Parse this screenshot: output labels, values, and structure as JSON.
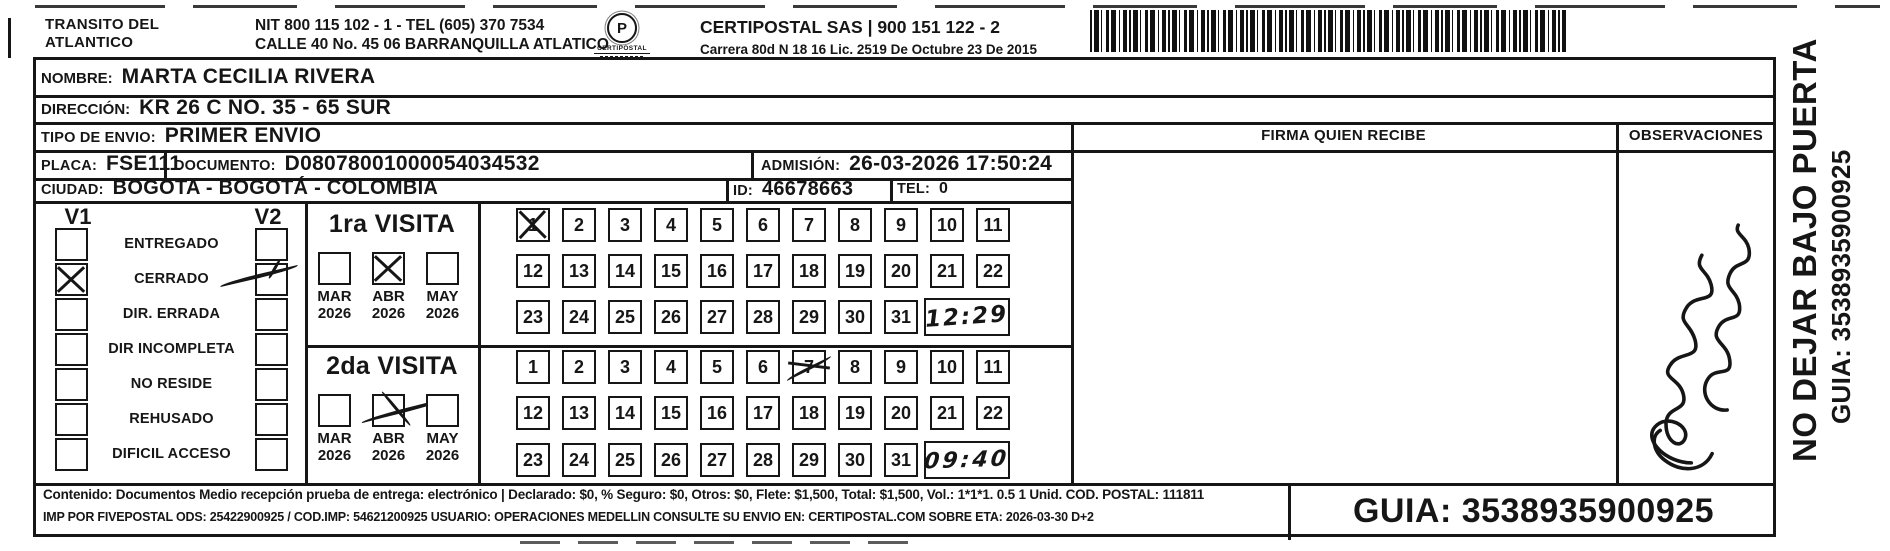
{
  "ink_color": "#161616",
  "paper_color": "#ffffff",
  "header": {
    "sender_line1": "TRANSITO DEL",
    "sender_line2": "ATLANTICO",
    "nit_line": "NIT 800 115 102 - 1 - TEL (605) 370 7534",
    "address_line": "CALLE 40 No. 45 06 BARRANQUILLA ATLATICO",
    "logo_glyph": "P",
    "logo_text": "CERTIPOSTAL",
    "company_line": "CERTIPOSTAL SAS | 900 151 122 - 2",
    "license_line": "Carrera 80d N 18 16  Lic. 2519 De Octubre 23 De 2015"
  },
  "fields": {
    "nombre_label": "NOMBRE:",
    "nombre": "MARTA CECILIA RIVERA",
    "direccion_label": "DIRECCIÓN:",
    "direccion": "KR 26 C NO. 35 - 65 SUR",
    "tipo_label": "TIPO DE ENVIO:",
    "tipo": "PRIMER ENVIO",
    "placa_label": "PLACA:",
    "placa": "FSE111",
    "documento_label": "DOCUMENTO:",
    "documento": "D08078001000054034532",
    "admision_label": "ADMISIÓN:",
    "admision": "26-03-2026 17:50:24",
    "ciudad_label": "CIUDAD:",
    "ciudad": "BOGOTA - BOGOTÁ - COLOMBIA",
    "id_label": "ID:",
    "id": "46678663",
    "tel_label": "TEL:",
    "tel": "0"
  },
  "columns": {
    "firma": "FIRMA QUIEN RECIBE",
    "observaciones": "OBSERVACIONES"
  },
  "status_panel": {
    "v1_header": "V1",
    "v2_header": "V2",
    "rows": [
      {
        "label": "ENTREGADO",
        "v1_checked": false,
        "v2_checked": false
      },
      {
        "label": "CERRADO",
        "v1_checked": true,
        "v1_mark": "printed-x",
        "v2_checked": true,
        "v2_mark": "handwritten"
      },
      {
        "label": "DIR. ERRADA",
        "v1_checked": false,
        "v2_checked": false
      },
      {
        "label": "DIR INCOMPLETA",
        "v1_checked": false,
        "v2_checked": false
      },
      {
        "label": "NO RESIDE",
        "v1_checked": false,
        "v2_checked": false
      },
      {
        "label": "REHUSADO",
        "v1_checked": false,
        "v2_checked": false
      },
      {
        "label": "DIFICIL ACCESO",
        "v1_checked": false,
        "v2_checked": false
      }
    ]
  },
  "visits": [
    {
      "title": "1ra VISITA",
      "months": [
        {
          "month": "MAR",
          "year": "2026",
          "checked": false
        },
        {
          "month": "ABR",
          "year": "2026",
          "checked": true,
          "mark": "printed-x"
        },
        {
          "month": "MAY",
          "year": "2026",
          "checked": false
        }
      ],
      "days": [
        1,
        2,
        3,
        4,
        5,
        6,
        7,
        8,
        9,
        10,
        11,
        12,
        13,
        14,
        15,
        16,
        17,
        18,
        19,
        20,
        21,
        22,
        23,
        24,
        25,
        26,
        27,
        28,
        29,
        30,
        31
      ],
      "crossed_day": 1,
      "crossed_day_mark": "printed-x",
      "time_note": "12:29"
    },
    {
      "title": "2da VISITA",
      "months": [
        {
          "month": "MAR",
          "year": "2026",
          "checked": false
        },
        {
          "month": "ABR",
          "year": "2026",
          "checked": true,
          "mark": "handwritten-x"
        },
        {
          "month": "MAY",
          "year": "2026",
          "checked": false
        }
      ],
      "days": [
        1,
        2,
        3,
        4,
        5,
        6,
        7,
        8,
        9,
        10,
        11,
        12,
        13,
        14,
        15,
        16,
        17,
        18,
        19,
        20,
        21,
        22,
        23,
        24,
        25,
        26,
        27,
        28,
        29,
        30,
        31
      ],
      "crossed_day": 7,
      "crossed_day_mark": "handwritten",
      "time_note": "09:40"
    }
  ],
  "footer": {
    "line1": "Contenido: Documentos Medio recepción prueba de entrega: electrónico | Declarado: $0, % Seguro: $0, Otros: $0, Flete: $1,500, Total: $1,500, Vol.: 1*1*1. 0.5  1 Unid. COD. POSTAL: 111811",
    "line2": "IMP POR FIVEPOSTAL ODS: 25422900925 / COD.IMP: 54621200925 USUARIO: OPERACIONES MEDELLIN CONSULTE SU ENVIO EN: CERTIPOSTAL.COM SOBRE ETA: 2026-03-30 D+2",
    "guia": "GUIA: 3538935900925"
  },
  "side_note": {
    "line1": "NO DEJAR BAJO PUERTA",
    "line2": "GUIA: 3538935900925"
  }
}
